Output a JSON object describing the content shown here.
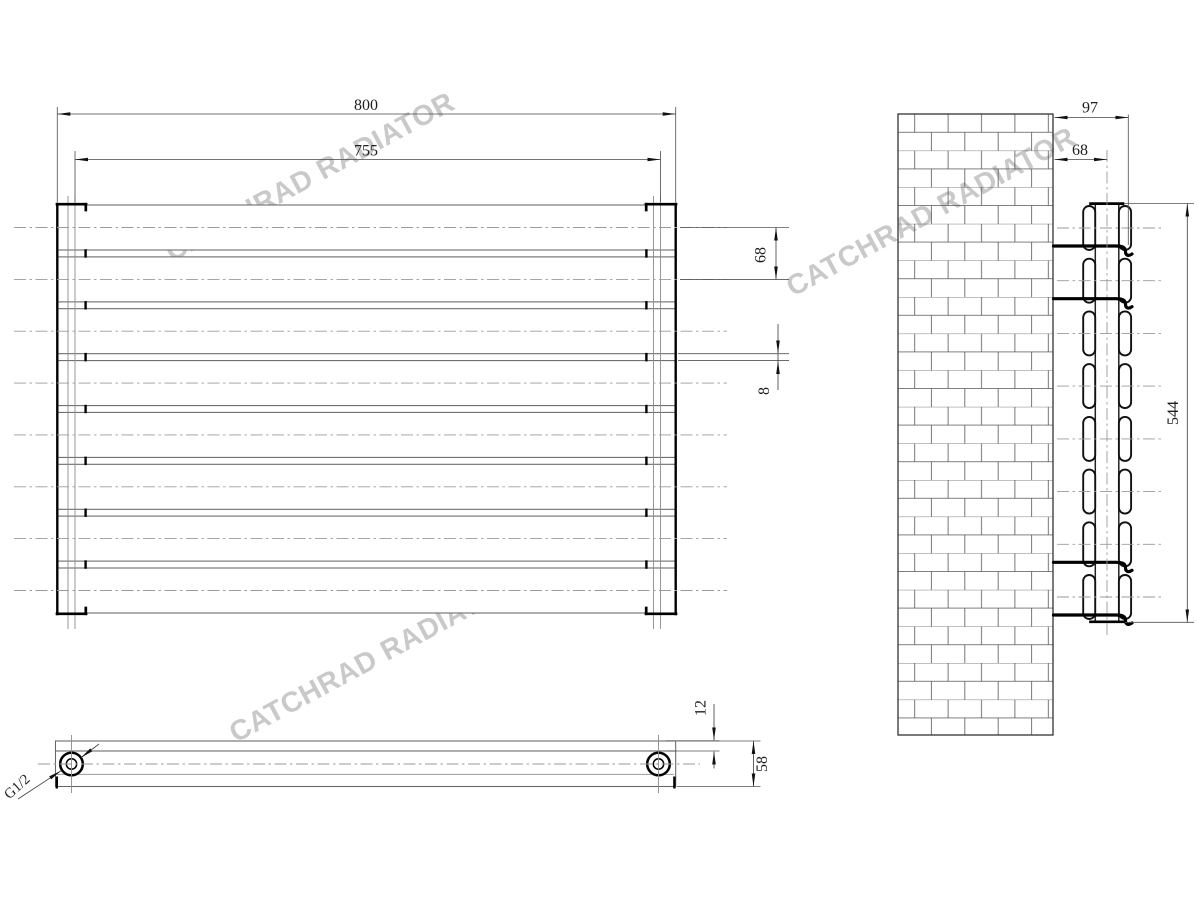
{
  "drawing": {
    "watermark_text": "CATCHRAD RADIATOR",
    "front_view": {
      "overall_width": "800",
      "connection_spacing": "755",
      "panel_pitch": "68",
      "panel_gap": "8",
      "panel_count": 8
    },
    "side_view": {
      "depth": "97",
      "wall_to_axis": "68",
      "height": "544"
    },
    "bottom_view": {
      "panel_thickness": "12",
      "total_depth": "58",
      "thread_size": "G1/2"
    }
  }
}
